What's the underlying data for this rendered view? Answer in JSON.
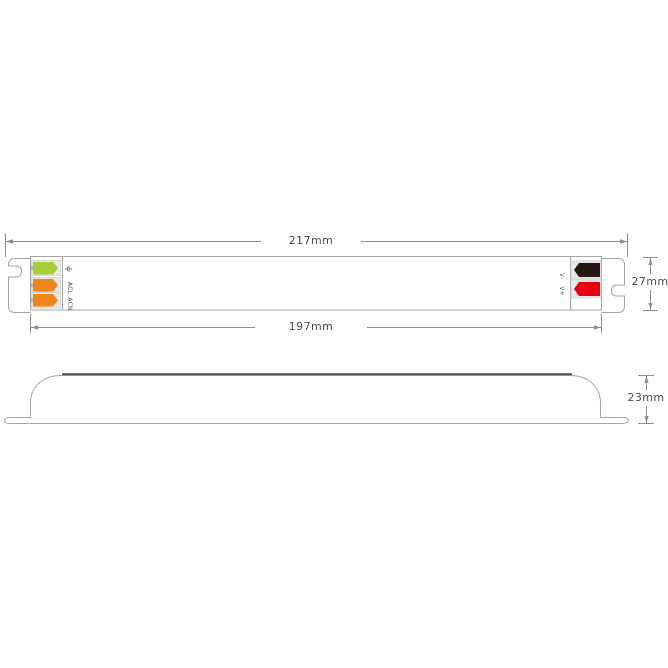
{
  "dimensions": {
    "overall_length": "217mm",
    "body_length": "197mm",
    "body_height": "27mm",
    "profile_height": "23mm"
  },
  "input_terminals": {
    "earth": {
      "icon": "earth-ground-icon",
      "wire_color": "#a5ce39"
    },
    "line": {
      "label": "ACL",
      "wire_color": "#f08519"
    },
    "neutral": {
      "label": "ACN",
      "wire_color": "#f08519"
    }
  },
  "output_terminals": {
    "negative": {
      "label": "V-",
      "wire_color": "#231815"
    },
    "positive": {
      "label": "V+",
      "wire_color": "#e60012"
    }
  },
  "colors": {
    "outline": "#a1a5a6",
    "dark_edge": "#4f4f4f",
    "dimension": "#8f8f8f",
    "slot_fill": "#e8e8e5",
    "slot_stroke": "#cfcfcc",
    "screw": "#8b8b8b",
    "background": "#ffffff"
  }
}
